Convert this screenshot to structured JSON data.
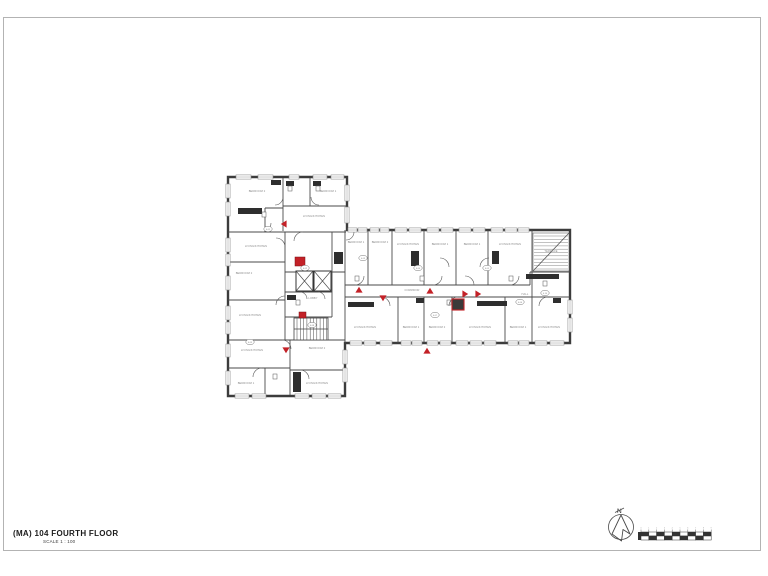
{
  "page": {
    "title": "(MA) 104 FOURTH FLOOR",
    "scale_label": "SCALE 1 : 100",
    "north_label": "N"
  },
  "colors": {
    "wall": "#3c3c3c",
    "thin": "#4a4a4a",
    "label": "#8a8a8a",
    "red": "#c32127",
    "fixture": "#2e2e2e",
    "window": "#8a8a8a"
  },
  "plan": {
    "outline": "M228,177 L347,177 L347,230 L570,230 L570,343 L345,343 L345,396 L228,396 Z",
    "walls": [
      [
        283,
        178,
        283,
        231
      ],
      [
        310,
        178,
        310,
        206
      ],
      [
        283,
        206,
        346,
        206
      ],
      [
        228,
        232,
        346,
        232
      ],
      [
        265,
        208,
        265,
        232
      ],
      [
        265,
        208,
        283,
        208
      ],
      [
        285,
        232,
        285,
        340
      ],
      [
        228,
        262,
        285,
        262
      ],
      [
        228,
        300,
        285,
        300
      ],
      [
        228,
        340,
        345,
        340
      ],
      [
        228,
        368,
        290,
        368
      ],
      [
        265,
        368,
        265,
        395
      ],
      [
        290,
        340,
        290,
        395
      ],
      [
        290,
        370,
        345,
        370
      ],
      [
        332,
        232,
        332,
        317
      ],
      [
        285,
        272,
        345,
        272
      ],
      [
        285,
        292,
        332,
        292
      ],
      [
        285,
        317,
        332,
        317
      ],
      [
        345,
        230,
        345,
        343
      ],
      [
        345,
        285,
        530,
        285
      ],
      [
        345,
        297,
        570,
        297
      ],
      [
        530,
        272,
        530,
        285
      ],
      [
        530,
        272,
        570,
        272
      ],
      [
        368,
        230,
        368,
        285
      ],
      [
        392,
        230,
        392,
        285
      ],
      [
        424,
        230,
        424,
        285
      ],
      [
        456,
        230,
        456,
        285
      ],
      [
        488,
        230,
        488,
        285
      ],
      [
        532,
        230,
        532,
        297
      ],
      [
        398,
        297,
        398,
        343
      ],
      [
        424,
        297,
        424,
        343
      ],
      [
        452,
        297,
        452,
        343
      ],
      [
        505,
        297,
        505,
        343
      ],
      [
        532,
        297,
        532,
        343
      ]
    ],
    "windows_h": [
      [
        236,
        177,
        15
      ],
      [
        258,
        177,
        15
      ],
      [
        289,
        177,
        10
      ],
      [
        313,
        177,
        14
      ],
      [
        331,
        177,
        13
      ],
      [
        348,
        230,
        9
      ],
      [
        358,
        230,
        9
      ],
      [
        370,
        230,
        9
      ],
      [
        380,
        230,
        9
      ],
      [
        395,
        230,
        12
      ],
      [
        409,
        230,
        12
      ],
      [
        427,
        230,
        12
      ],
      [
        441,
        230,
        12
      ],
      [
        459,
        230,
        12
      ],
      [
        473,
        230,
        12
      ],
      [
        491,
        230,
        12
      ],
      [
        505,
        230,
        12
      ],
      [
        518,
        230,
        11
      ],
      [
        350,
        343,
        12
      ],
      [
        364,
        343,
        12
      ],
      [
        380,
        343,
        12
      ],
      [
        401,
        343,
        10
      ],
      [
        412,
        343,
        10
      ],
      [
        427,
        343,
        11
      ],
      [
        440,
        343,
        11
      ],
      [
        456,
        343,
        12
      ],
      [
        470,
        343,
        12
      ],
      [
        484,
        343,
        12
      ],
      [
        508,
        343,
        10
      ],
      [
        519,
        343,
        10
      ],
      [
        535,
        343,
        12
      ],
      [
        550,
        343,
        14
      ],
      [
        235,
        396,
        14
      ],
      [
        252,
        396,
        14
      ],
      [
        295,
        396,
        14
      ],
      [
        312,
        396,
        14
      ],
      [
        328,
        396,
        13
      ]
    ],
    "windows_v": [
      [
        228,
        184,
        14
      ],
      [
        228,
        202,
        14
      ],
      [
        228,
        238,
        14
      ],
      [
        228,
        254,
        12
      ],
      [
        228,
        276,
        14
      ],
      [
        228,
        306,
        14
      ],
      [
        228,
        322,
        12
      ],
      [
        228,
        344,
        13
      ],
      [
        228,
        371,
        14
      ],
      [
        347,
        185,
        16
      ],
      [
        347,
        207,
        16
      ],
      [
        570,
        300,
        14
      ],
      [
        570,
        318,
        14
      ],
      [
        345,
        350,
        14
      ],
      [
        345,
        368,
        14
      ]
    ],
    "fixtures": [
      [
        238,
        208,
        24,
        6
      ],
      [
        271,
        180,
        10,
        5
      ],
      [
        286,
        181,
        8,
        5
      ],
      [
        313,
        181,
        8,
        5
      ],
      [
        348,
        302,
        26,
        5
      ],
      [
        477,
        301,
        30,
        5
      ],
      [
        526,
        274,
        33,
        5
      ],
      [
        411,
        251,
        8,
        15
      ],
      [
        492,
        251,
        7,
        13
      ],
      [
        334,
        252,
        9,
        12
      ],
      [
        287,
        295,
        9,
        5
      ],
      [
        293,
        372,
        8,
        20
      ],
      [
        416,
        298,
        8,
        5
      ],
      [
        553,
        298,
        8,
        5
      ]
    ],
    "fixtures_open": [
      [
        288,
        186,
        4,
        5
      ],
      [
        316,
        186,
        4,
        5
      ],
      [
        273,
        374,
        4,
        5
      ],
      [
        296,
        300,
        4,
        5
      ],
      [
        355,
        276,
        4,
        5
      ],
      [
        420,
        276,
        4,
        5
      ],
      [
        447,
        300,
        4,
        5
      ],
      [
        509,
        276,
        4,
        5
      ],
      [
        543,
        281,
        4,
        5
      ],
      [
        262,
        212,
        4,
        5
      ]
    ],
    "doors": [
      "M271,223 A9,9 0 0 1 262,232",
      "M283,197 A8,8 0 0 1 275,205",
      "M311,197 A8,8 0 0 0 319,205",
      "M276,238 A9,9 0 0 1 285,247",
      "M285,296 A9,9 0 0 0 276,305",
      "M294,241 A9,9 0 0 1 303,232",
      "M354,232 A8,8 0 0 1 346,240",
      "M355,285 A9,9 0 0 0 364,276",
      "M381,297 A9,9 0 0 1 390,306",
      "M433,285 A9,9 0 0 0 442,276",
      "M474,285 A9,9 0 0 0 465,276",
      "M449,306 A9,9 0 0 1 458,297",
      "M510,285 A9,9 0 0 0 519,276",
      "M539,306 A9,9 0 0 1 548,297",
      "M253,377 A9,9 0 0 1 262,368",
      "M300,370 A9,9 0 0 1 309,379",
      "M282,340 A9,9 0 0 1 291,349",
      "M440,258 A9,9 0 0 1 449,267",
      "M489,258 A9,9 0 0 0 480,267",
      "M300,292 A7,7 0 0 1 307,299",
      "M318,292 A7,7 0 0 1 325,299"
    ],
    "elevators": [
      [
        296,
        271,
        17,
        20
      ],
      [
        314,
        271,
        17,
        20
      ]
    ],
    "stair": {
      "x": 294,
      "y": 318,
      "w": 34,
      "h": 22
    },
    "terrace": {
      "x": 533,
      "y": 233,
      "w": 36,
      "h": 38
    },
    "red_squares": [
      [
        295,
        257,
        10,
        9
      ],
      [
        299,
        312,
        7,
        6
      ]
    ],
    "red_box": [
      452,
      299,
      12,
      11
    ],
    "red_tris": [
      [
        284,
        224,
        270
      ],
      [
        359,
        290,
        0
      ],
      [
        383,
        298,
        180
      ],
      [
        430,
        291,
        0
      ],
      [
        465,
        294,
        90
      ],
      [
        478,
        294,
        90
      ],
      [
        286,
        350,
        180
      ],
      [
        427,
        351,
        0
      ]
    ],
    "room_labels": [
      {
        "x": 257,
        "y": 192,
        "t": "BEDROOM 2"
      },
      {
        "x": 328,
        "y": 192,
        "t": "BEDROOM 1"
      },
      {
        "x": 314,
        "y": 217,
        "t": "LIVING/KITCHEN"
      },
      {
        "x": 256,
        "y": 247,
        "t": "LIVING/KITCHEN"
      },
      {
        "x": 244,
        "y": 274,
        "t": "BEDROOM 2"
      },
      {
        "x": 250,
        "y": 316,
        "t": "LIVING/KITCHEN"
      },
      {
        "x": 252,
        "y": 351,
        "t": "LIVING/KITCHEN"
      },
      {
        "x": 246,
        "y": 384,
        "t": "BEDROOM 1"
      },
      {
        "x": 317,
        "y": 349,
        "t": "BEDROOM 2"
      },
      {
        "x": 317,
        "y": 384,
        "t": "LIVING/KITCHEN"
      },
      {
        "x": 313,
        "y": 299,
        "t": "LOBBY"
      },
      {
        "x": 356,
        "y": 243,
        "t": "BEDROOM 1"
      },
      {
        "x": 380,
        "y": 243,
        "t": "BEDROOM 2"
      },
      {
        "x": 408,
        "y": 245,
        "t": "LIVING/KITCHEN"
      },
      {
        "x": 440,
        "y": 245,
        "t": "BEDROOM 1"
      },
      {
        "x": 472,
        "y": 245,
        "t": "BEDROOM 1"
      },
      {
        "x": 510,
        "y": 245,
        "t": "LIVING/KITCHEN"
      },
      {
        "x": 551,
        "y": 252,
        "t": "TERRACE"
      },
      {
        "x": 412,
        "y": 291,
        "t": "CORRIDOR"
      },
      {
        "x": 525,
        "y": 295,
        "t": "HALL"
      },
      {
        "x": 365,
        "y": 328,
        "t": "LIVING/KITCHEN"
      },
      {
        "x": 411,
        "y": 328,
        "t": "BEDROOM 1"
      },
      {
        "x": 437,
        "y": 328,
        "t": "BEDROOM 2"
      },
      {
        "x": 480,
        "y": 328,
        "t": "LIVING/KITCHEN"
      },
      {
        "x": 518,
        "y": 328,
        "t": "BEDROOM 1"
      },
      {
        "x": 549,
        "y": 328,
        "t": "LIVING/KITCHEN"
      }
    ],
    "badges": [
      {
        "x": 268,
        "y": 229,
        "t": "4.01"
      },
      {
        "x": 305,
        "y": 268,
        "t": "4.02"
      },
      {
        "x": 363,
        "y": 258,
        "t": "4.03"
      },
      {
        "x": 418,
        "y": 268,
        "t": "4.04"
      },
      {
        "x": 487,
        "y": 268,
        "t": "4.05"
      },
      {
        "x": 520,
        "y": 302,
        "t": "4.06"
      },
      {
        "x": 435,
        "y": 315,
        "t": "4.07"
      },
      {
        "x": 312,
        "y": 325,
        "t": "4.08"
      },
      {
        "x": 250,
        "y": 342,
        "t": "4.09"
      },
      {
        "x": 545,
        "y": 293,
        "t": "4.10"
      }
    ]
  },
  "compass": {
    "cx": 621,
    "cy": 527,
    "r": 12.5
  },
  "scalebar": {
    "x": 641,
    "y": 532,
    "seg_w": 7.8,
    "seg_h": 4,
    "segments": 9,
    "ticks": [
      "0",
      "1",
      "2",
      "3",
      "4",
      "5",
      "6",
      "7",
      "8",
      "9"
    ]
  }
}
